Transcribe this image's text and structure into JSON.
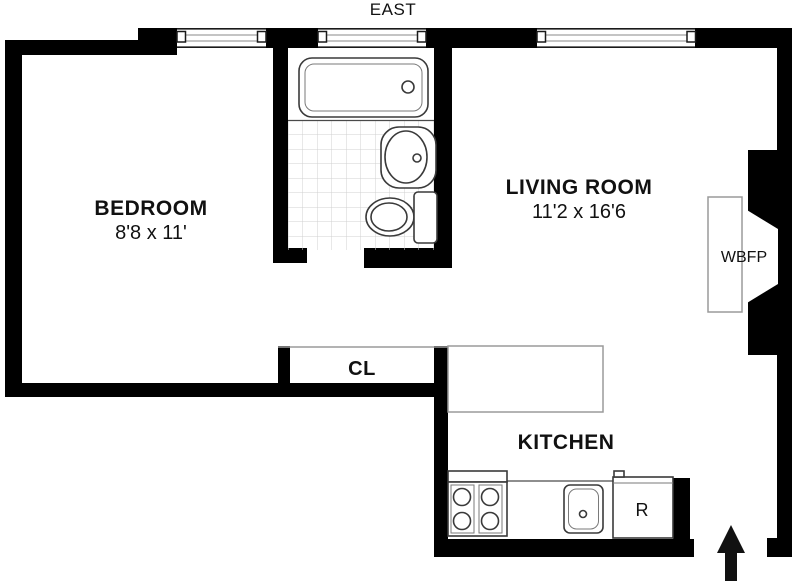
{
  "compass": {
    "label": "EAST"
  },
  "rooms": {
    "bedroom": {
      "name": "BEDROOM",
      "dimensions": "8'8 x 11'"
    },
    "living_room": {
      "name": "LIVING ROOM",
      "dimensions": "11'2 x 16'6"
    },
    "kitchen": {
      "name": "KITCHEN"
    },
    "closet": {
      "abbr": "CL"
    },
    "fireplace": {
      "abbr": "WBFP"
    },
    "refrigerator": {
      "abbr": "R"
    }
  },
  "fixtures": [
    "bathtub",
    "bathroom-sink",
    "toilet",
    "tiled-floor",
    "stove-4-burners",
    "kitchen-sink",
    "refrigerator",
    "fireplace-hearth",
    "kitchen-counter",
    "entry-arrow",
    "window-bedroom",
    "window-bathroom",
    "window-living-room"
  ],
  "colors": {
    "wall": "#000000",
    "background": "#ffffff",
    "fixture_line": "#3a3a3a",
    "thin_line": "#9a9a9a",
    "tile_line": "#d0d0d0",
    "text": "#111111"
  }
}
